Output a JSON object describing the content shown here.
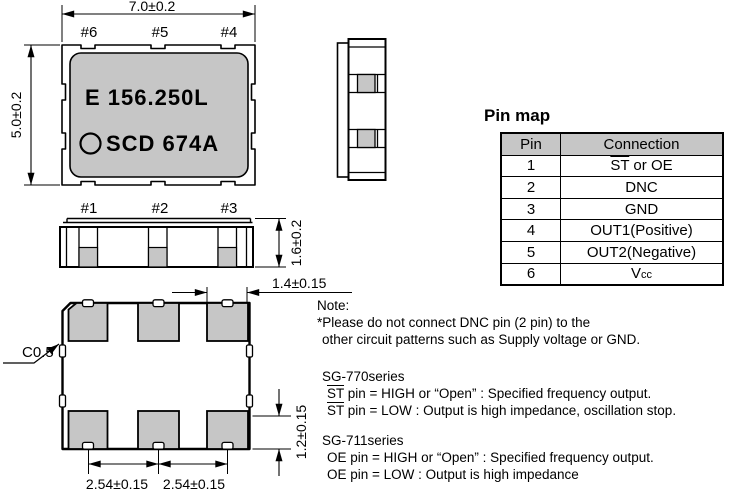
{
  "colors": {
    "body_fill": "#c6c6c6",
    "table_header_fill": "#c6c6c6",
    "line": "#000000"
  },
  "drawing": {
    "top_view": {
      "dim_width": "7.0±0.2",
      "dim_height": "5.0±0.2",
      "pins_top": [
        "#6",
        "#5",
        "#4"
      ],
      "pins_bottom": [
        "#1",
        "#2",
        "#3"
      ],
      "marking_line1": "E 156.250L",
      "marking_line2": "SCD 674A"
    },
    "front_view": {
      "dim_height": "1.6±0.2"
    },
    "bottom_view": {
      "chamfer": "C0.5",
      "dim_pad_width": "1.4±0.15",
      "dim_pad_height": "1.2±0.15",
      "dim_pitch_1": "2.54±0.15",
      "dim_pitch_2": "2.54±0.15"
    }
  },
  "pin_map": {
    "title": "Pin map",
    "headers": {
      "pin": "Pin",
      "connection": "Connection"
    },
    "rows": [
      {
        "pin": "1",
        "ov": "ST",
        "rest": " or OE",
        "sub": ""
      },
      {
        "pin": "2",
        "ov": "",
        "rest": "DNC",
        "sub": ""
      },
      {
        "pin": "3",
        "ov": "",
        "rest": "GND",
        "sub": ""
      },
      {
        "pin": "4",
        "ov": "",
        "rest": "OUT1(Positive)",
        "sub": ""
      },
      {
        "pin": "5",
        "ov": "",
        "rest": "OUT2(Negative)",
        "sub": ""
      },
      {
        "pin": "6",
        "ov": "",
        "rest": "V",
        "sub": "cc"
      }
    ]
  },
  "notes": {
    "title": "Note:",
    "warning_line1": "*Please do not connect DNC pin (2 pin) to the",
    "warning_line2": "other circuit patterns such as Supply voltage or GND.",
    "sg770": {
      "title": "SG-770series",
      "line1_ov": "ST",
      "line1_rest": " pin = HIGH or “Open” : Specified frequency output.",
      "line2_ov": "ST",
      "line2_rest": " pin = LOW : Output is high impedance, oscillation stop."
    },
    "sg711": {
      "title": "SG-711series",
      "line1": "OE pin = HIGH or “Open” : Specified frequency output.",
      "line2": "OE pin = LOW : Output is high impedance"
    }
  }
}
